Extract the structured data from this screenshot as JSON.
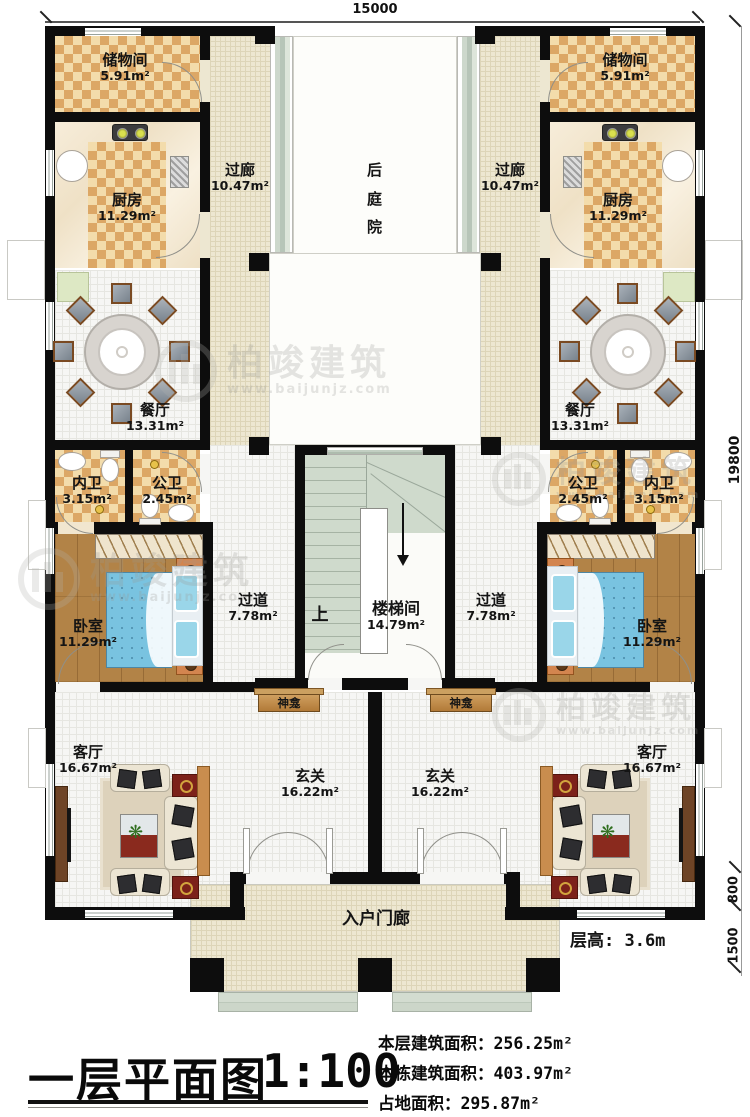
{
  "meta": {
    "title_cn": "一层平面图",
    "scale": "1:100"
  },
  "dims": {
    "top": "15000",
    "side": "19800",
    "step": "800",
    "porch": "1500"
  },
  "annotations": {
    "floor_height": "层高: 3.6m",
    "up": "上"
  },
  "rooms": {
    "storage": {
      "name": "储物间",
      "area": "5.91m²"
    },
    "kitchen": {
      "name": "厨房",
      "area": "11.29m²"
    },
    "corridor": {
      "name": "过廊",
      "area": "10.47m²"
    },
    "courtyard": {
      "name": "后庭院"
    },
    "dining": {
      "name": "餐厅",
      "area": "13.31m²"
    },
    "inner_bath": {
      "name": "内卫",
      "area": "3.15m²"
    },
    "public_bath": {
      "name": "公卫",
      "area": "2.45m²"
    },
    "bedroom": {
      "name": "卧室",
      "area": "11.29m²"
    },
    "passage": {
      "name": "过道",
      "area": "7.78m²"
    },
    "stairwell": {
      "name": "楼梯间",
      "area": "14.79m²"
    },
    "shrine": {
      "name": "神龛"
    },
    "living": {
      "name": "客厅",
      "area": "16.67m²"
    },
    "foyer": {
      "name": "玄关",
      "area": "16.22m²"
    },
    "porch": {
      "name": "入户门廊"
    }
  },
  "stats": {
    "floor_area": {
      "label": "本层建筑面积：",
      "value": "256.25m²"
    },
    "building_area": {
      "label": "本栋建筑面积：",
      "value": "403.97m²"
    },
    "footprint": {
      "label": "占地面积：",
      "value": "295.87m²"
    }
  },
  "watermark": {
    "brand": "柏竣建筑",
    "url": "www.baijunjz.com"
  },
  "colors": {
    "wall": "#0d0d0d",
    "checker_dark": "#dca765",
    "checker_light": "#f3dcab",
    "wood": "#b28347",
    "bed": "#79c3e0",
    "glazing": "#c7d3c5",
    "accent_red": "#7c211a"
  }
}
